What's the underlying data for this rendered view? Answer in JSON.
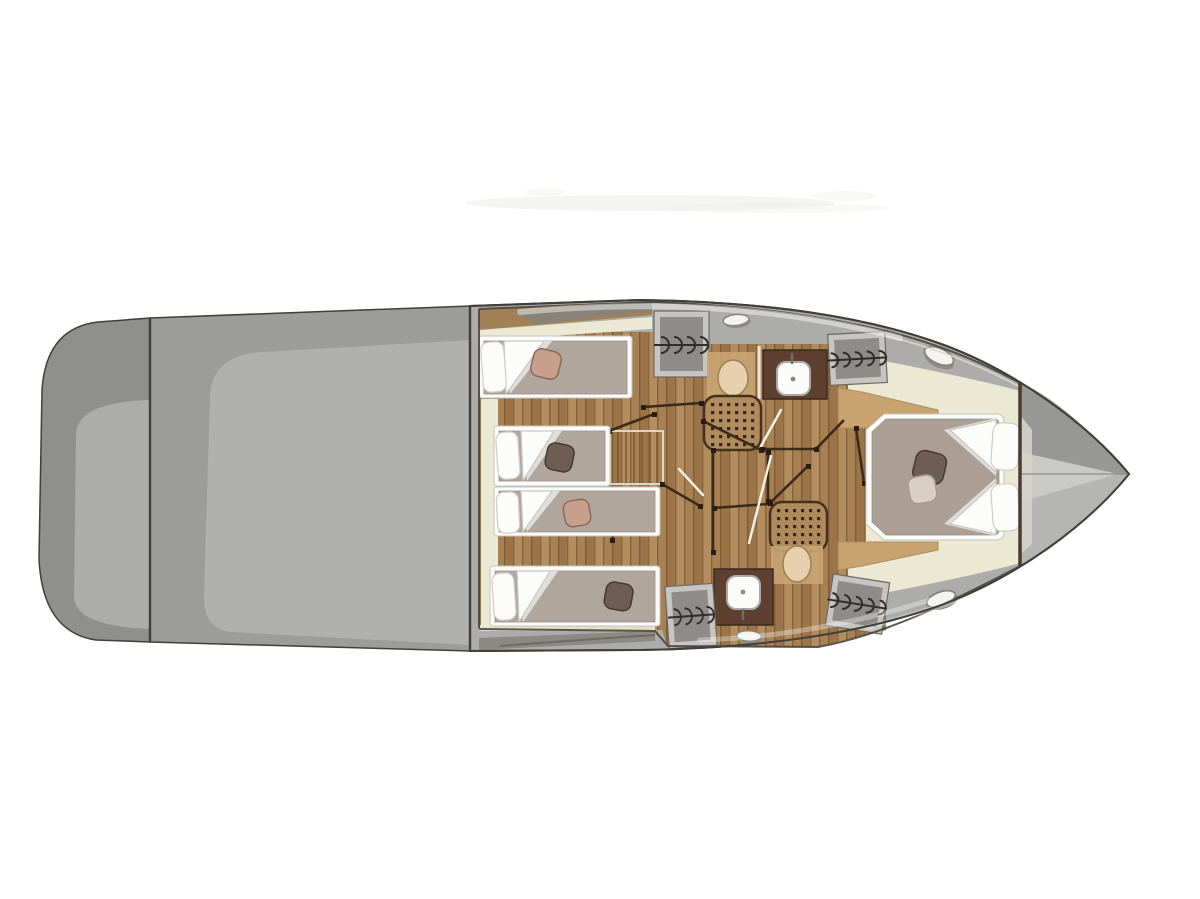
{
  "image": {
    "kind": "yacht-deck-floor-plan",
    "view": "top-down",
    "orientation": {
      "bow": "right",
      "stern": "left"
    }
  },
  "colors": {
    "background": "#ffffff",
    "smudge": "#ebebe9",
    "hull_outline": "#413f3b",
    "deck_grey": "#acacaa",
    "deck_mid": "#9c9c9a",
    "deck_dark": "#84827c",
    "stern_dark": "#8f8f8d",
    "stern_panel": "#acacaa",
    "aft_panel": "#b0b0ae",
    "wall_cream": "#ebe9d4",
    "wood": "#b48d5e",
    "wood_mid": "#a88152",
    "wood_deep": "#9c7448",
    "wood_gap": "#6b4c2e",
    "wood_light": "#c8a36f",
    "wood_trim": "#a28157",
    "counter_brown": "#5d4030",
    "shower_base": "#b08b5b",
    "shower_frame": "#46301e",
    "shower_dot": "#38271a",
    "white_fixture": "#fbfbf9",
    "basin_stroke": "#aba9a5",
    "toilet": "#e6d0ad",
    "toilet_surround": "#c9a574",
    "toilet_stroke": "#9a7f57",
    "wardrobe_frame": "#c7c5c1",
    "wardrobe_inner": "#8f8b89",
    "symbol": "#2f2d2b",
    "door_line": "#3e2a1a",
    "door_leaf": "#f5f3ea",
    "hinge": "#2a1d12",
    "mattress": "#b1a69c",
    "mattress_master": "#ab9e95",
    "pillow": "#fcfcfa",
    "duvet_shadow": "#e0ded8",
    "cushion_dark": "#6e5d52",
    "cushion_rose": "#c69f8d",
    "cushion_light": "#d8cec4",
    "hatch": "#f3f3f1",
    "hatch_stroke": "#87857f",
    "bow_upper": "#979795",
    "bow_lower": "#b5b5b3",
    "bow_light": "#c9c9c5",
    "bulkhead": "#4a3b32",
    "highlight": "#ffffff",
    "inner_line": "#4a463e",
    "light_edge": "#d9d7cf"
  },
  "rooms": [
    {
      "name": "swim-platform",
      "position": "far-stern"
    },
    {
      "name": "aft-deck",
      "position": "stern"
    },
    {
      "name": "twin-cabin-upper",
      "berths": 2
    },
    {
      "name": "twin-cabin-lower",
      "berths": 2
    },
    {
      "name": "bathroom-starboard",
      "fixtures": [
        "toilet",
        "shower",
        "washbasin"
      ]
    },
    {
      "name": "bathroom-port",
      "fixtures": [
        "shower",
        "toilet",
        "washbasin"
      ]
    },
    {
      "name": "corridor-with-companionway-stairs"
    },
    {
      "name": "master-cabin",
      "berths": 1,
      "bed": "island-double"
    },
    {
      "name": "bow-locker",
      "position": "bow"
    }
  ],
  "fixtures": {
    "single_berths": 4,
    "double_berths": 1,
    "toilets": 2,
    "showers": 2,
    "washbasins": 2,
    "wardrobes": 4,
    "deck_hatches": 4,
    "stairs": 1
  }
}
